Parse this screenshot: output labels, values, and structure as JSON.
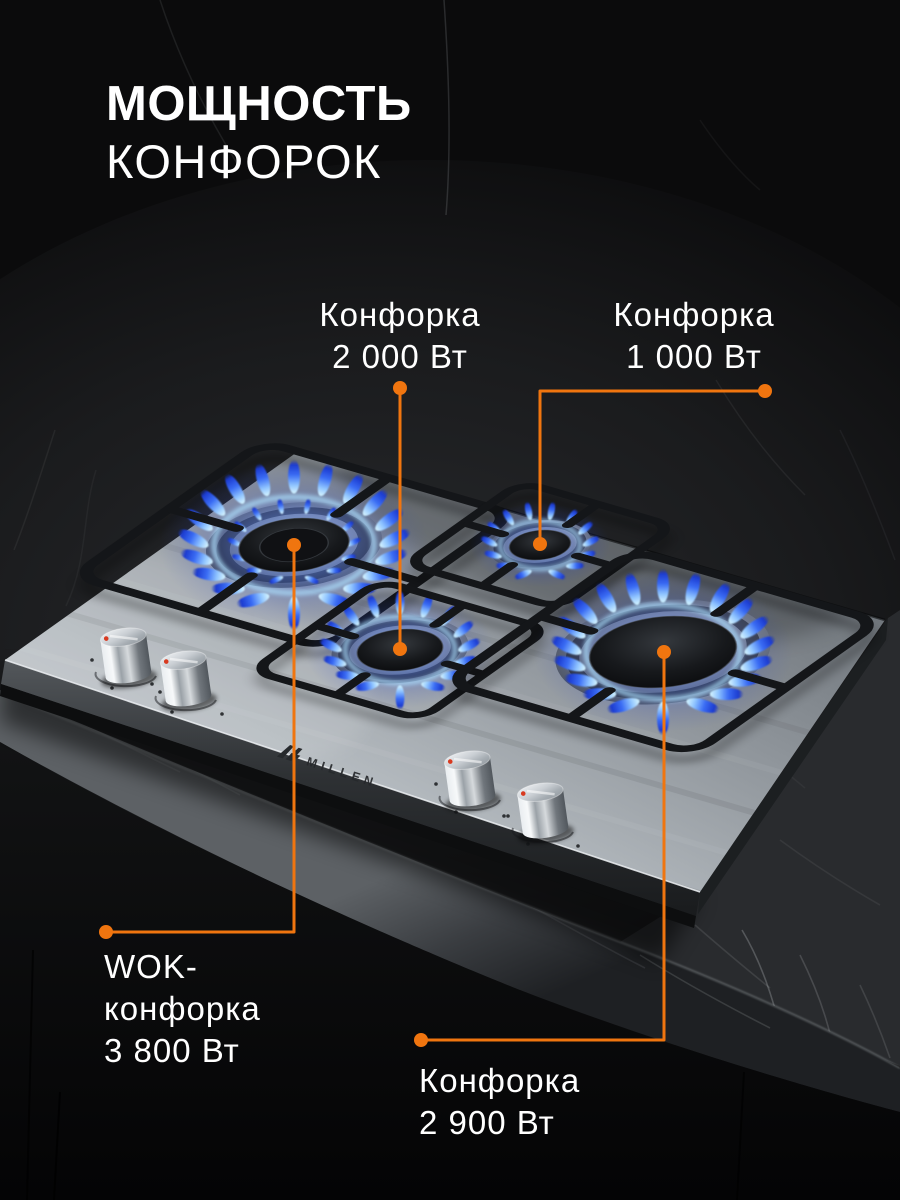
{
  "title": {
    "line1": "МОЩНОСТЬ",
    "line2": "КОНФОРОК"
  },
  "callouts": {
    "b2000": {
      "line1": "Конфорка",
      "line2": "2 000 Вт"
    },
    "b1000": {
      "line1": "Конфорка",
      "line2": "1 000 Вт"
    },
    "wok": {
      "line1": "WOK-",
      "line2": "конфорка",
      "line3": "3 800 Вт"
    },
    "b2900": {
      "line1": "Конфорка",
      "line2": "2 900 Вт"
    }
  },
  "brand": {
    "name": "MILLEN"
  },
  "colors": {
    "accent": "#F0750F",
    "text": "#FFFFFF",
    "flame_outer_blue": "#1C3BD0",
    "flame_inner_cyan": "#D9F6FF",
    "knob_indicator_red": "#D83A20",
    "background": "#0A0A0B"
  }
}
